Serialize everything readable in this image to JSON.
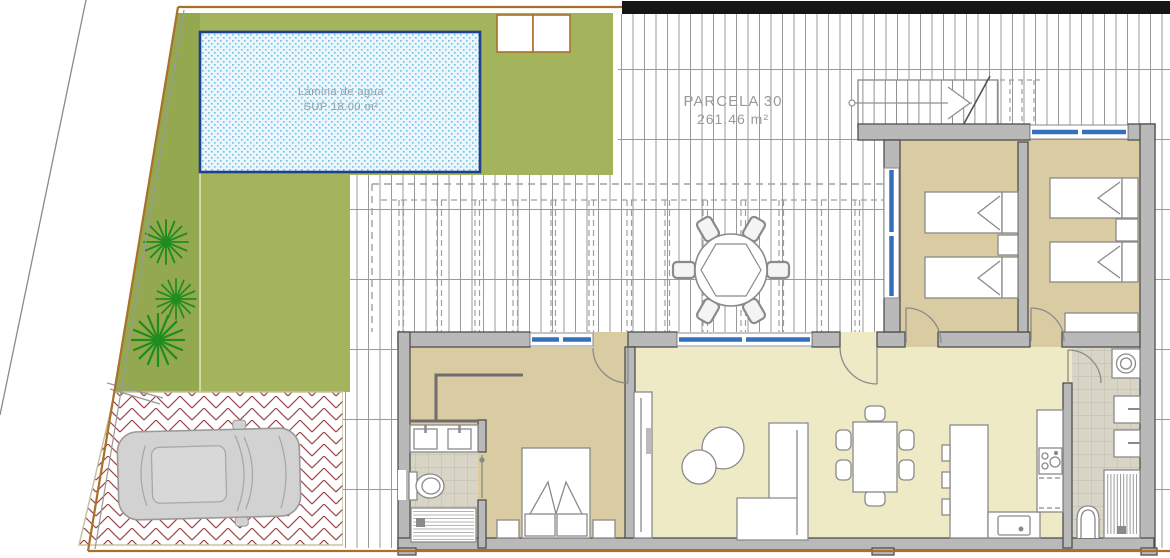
{
  "labels": {
    "pool_line1": "Lámina de agua",
    "pool_line2": "SUP 18.00 m²",
    "parcel_line1": "PARCELA 30",
    "parcel_line2": "261.46 m²"
  },
  "colors": {
    "grass": "#a4b45c",
    "grass_dark": "#94a84f",
    "pool_water": "#eaf6fb",
    "pool_border": "#1d3f8e",
    "pool_dots": "#6fc0e0",
    "deck_line": "#9a9a9a",
    "wall_fill": "#b9b9b9",
    "wall_stroke": "#4f4f4f",
    "floor_bedroom": "#d9cba2",
    "floor_living": "#eeeac6",
    "floor_bath": "#d8d4c6",
    "window_blue": "#3570bf",
    "brick_red": "#9b4444",
    "boundary_orange": "#a8702a",
    "tree_green": "#1e8c1e",
    "car_body": "#d2d2d2",
    "furniture_stroke": "#8a8a8a",
    "label_gray": "#9a9a9a",
    "top_bar_black": "#161616"
  }
}
